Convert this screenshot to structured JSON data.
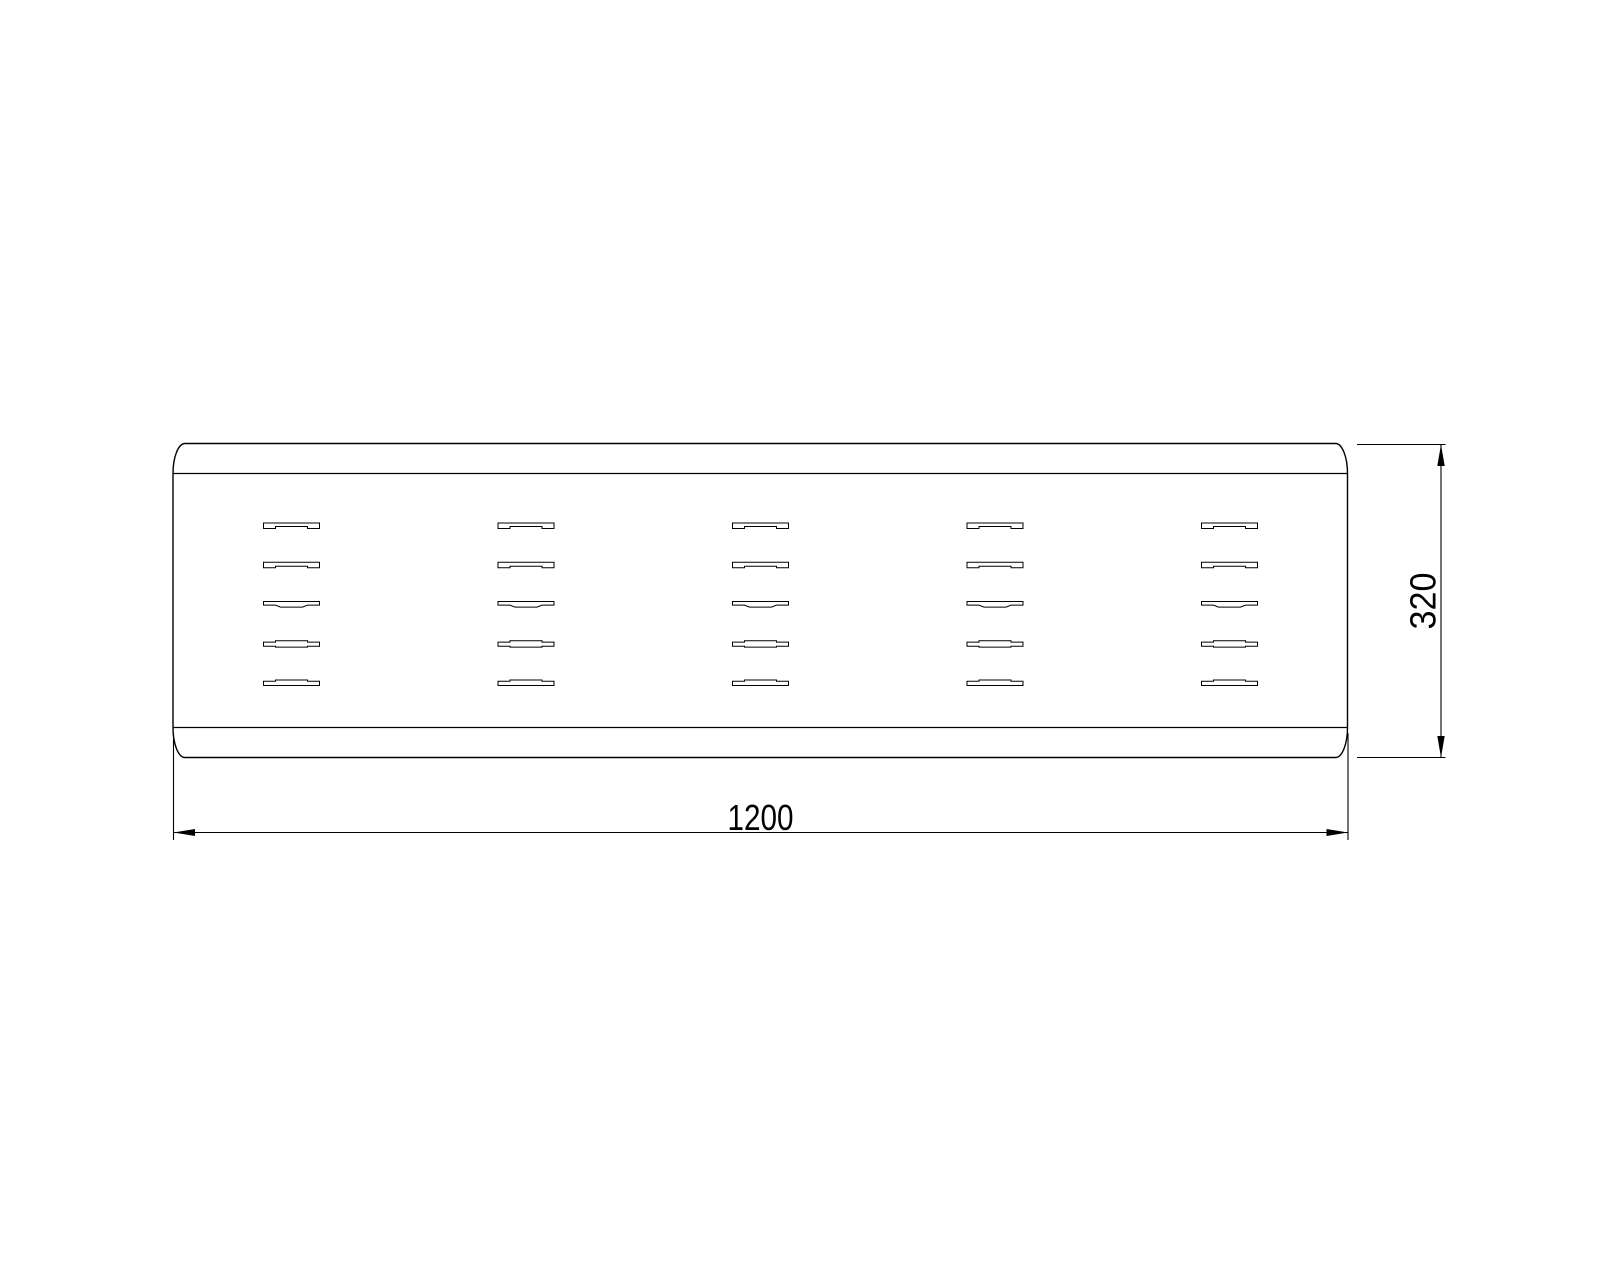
{
  "drawing": {
    "background_color": "#ffffff",
    "line_color": "#000000",
    "width_dimension": {
      "label": "1200"
    },
    "height_dimension": {
      "label": "320"
    },
    "vent_grid": {
      "columns": 5,
      "rows": 5
    }
  }
}
